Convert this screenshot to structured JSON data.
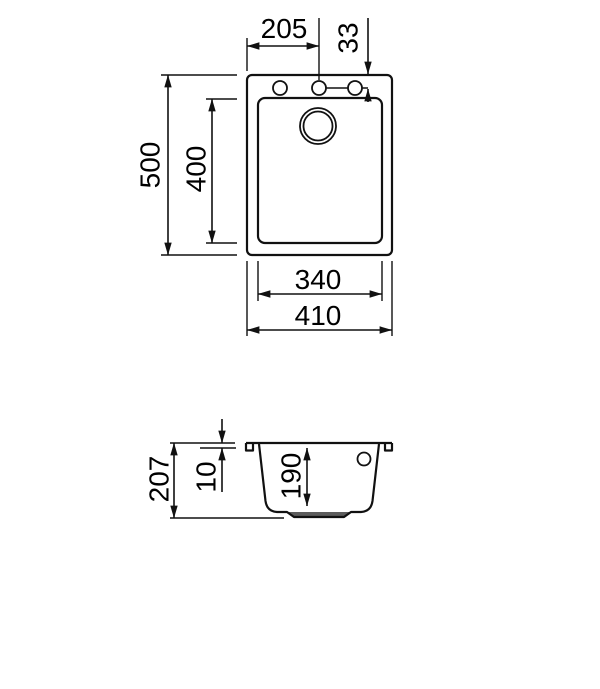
{
  "diagram": {
    "background_color": "#ffffff",
    "line_color": "#111111",
    "drain_recess_fill": "#5c5c5c",
    "top_view": {
      "tap_hole_offset_x": "205",
      "tap_hole_offset_y": "33",
      "outer_depth": "500",
      "bowl_depth": "400",
      "bowl_width": "340",
      "outer_width": "410"
    },
    "side_view": {
      "total_height": "207",
      "rim_thickness": "10",
      "bowl_inner_depth": "190"
    }
  }
}
